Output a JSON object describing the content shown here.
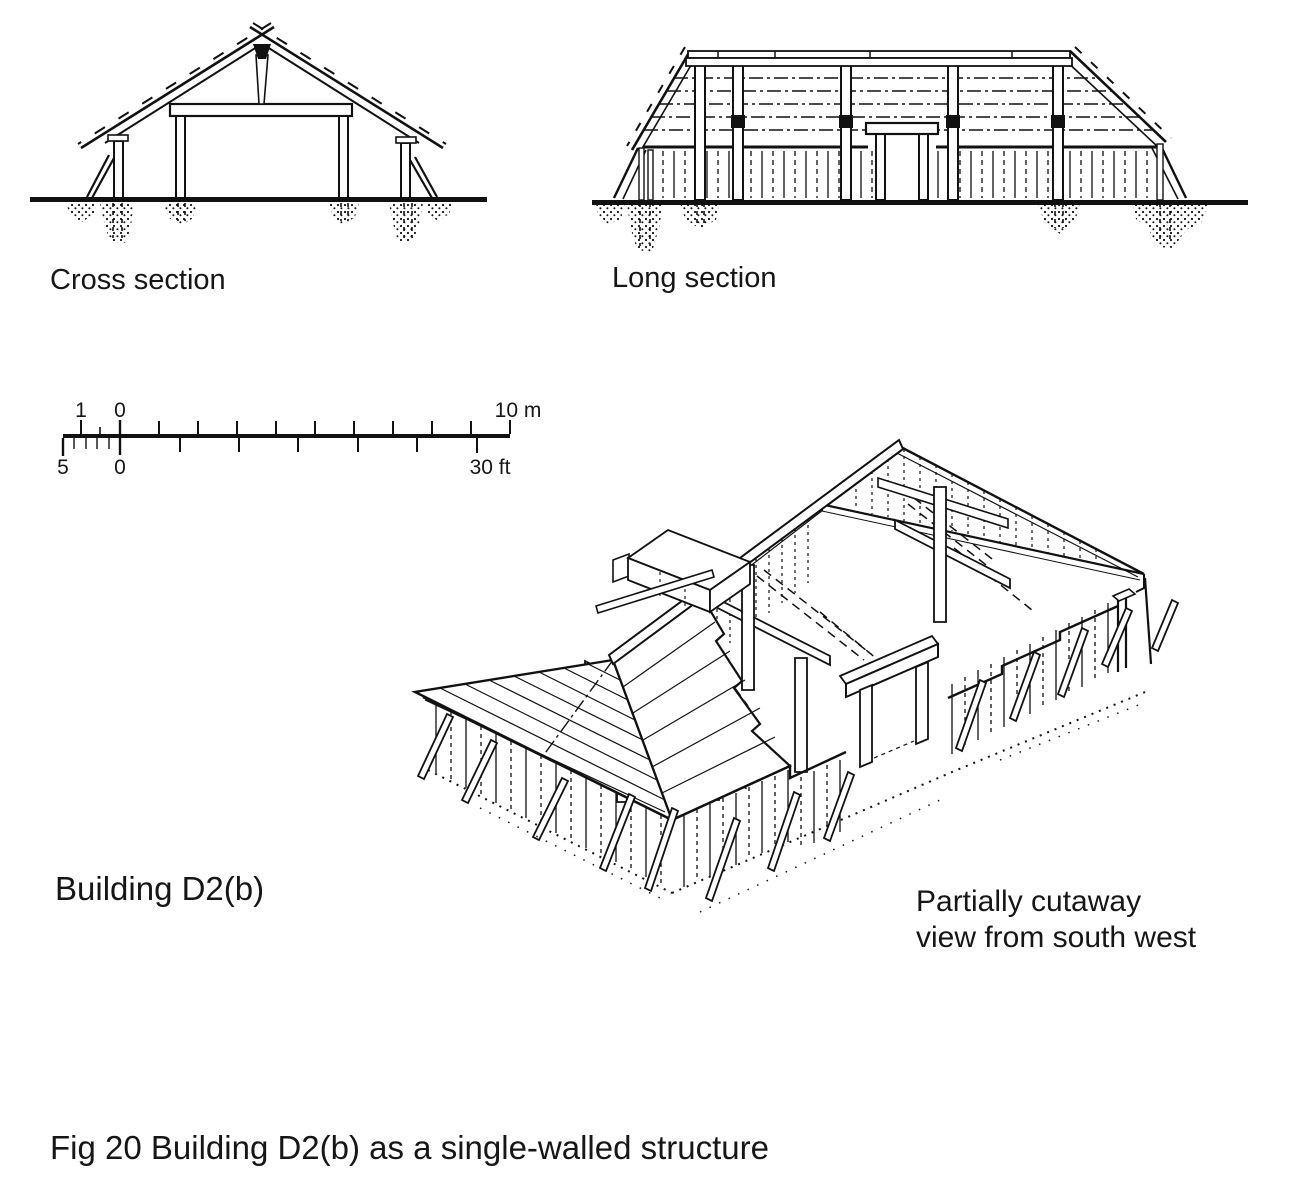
{
  "page": {
    "background": "#ffffff",
    "ink": "#111111"
  },
  "figure": {
    "caption": "Fig 20 Building D2(b) as a single-walled structure",
    "building_label": "Building D2(b)"
  },
  "panels": {
    "cross_section": {
      "label": "Cross section"
    },
    "long_section": {
      "label": "Long section"
    },
    "isometric": {
      "label_line1": "Partially cutaway",
      "label_line2": "view from south west"
    }
  },
  "scale_bar": {
    "meters": {
      "minor_left_label": "1",
      "zero_label": "0",
      "max_label": "10 m",
      "max": 10
    },
    "feet": {
      "minor_left_label": "5",
      "zero_label": "0",
      "max_label": "30 ft",
      "max": 30
    }
  }
}
